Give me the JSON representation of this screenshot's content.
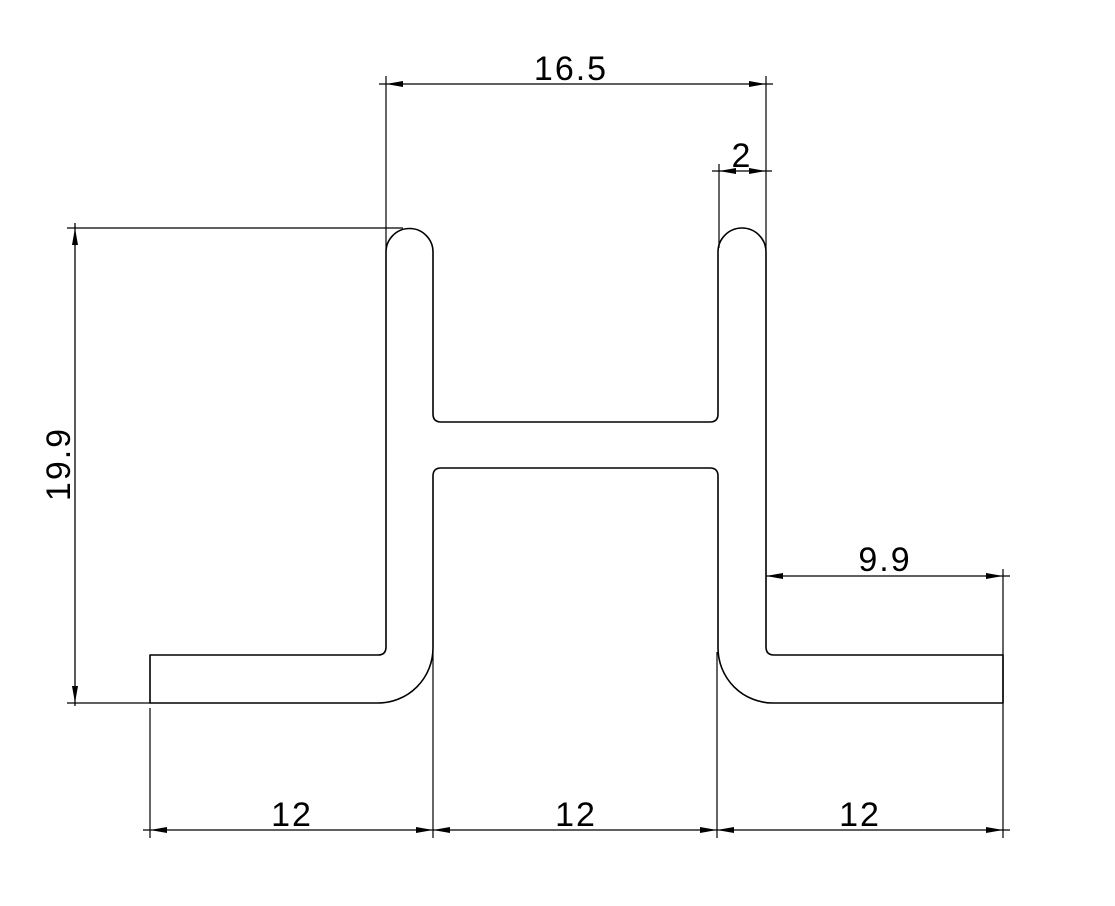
{
  "drawing": {
    "type": "technical-cad-profile-cross-section",
    "background_color": "#ffffff",
    "line_color": "#000000",
    "dimensions": {
      "top_width": "16.5",
      "wall_thickness": "2",
      "overall_height": "19.9",
      "right_flange_width": "9.9",
      "bottom_left_width": "12",
      "bottom_middle_width": "12",
      "bottom_right_width": "12"
    }
  }
}
